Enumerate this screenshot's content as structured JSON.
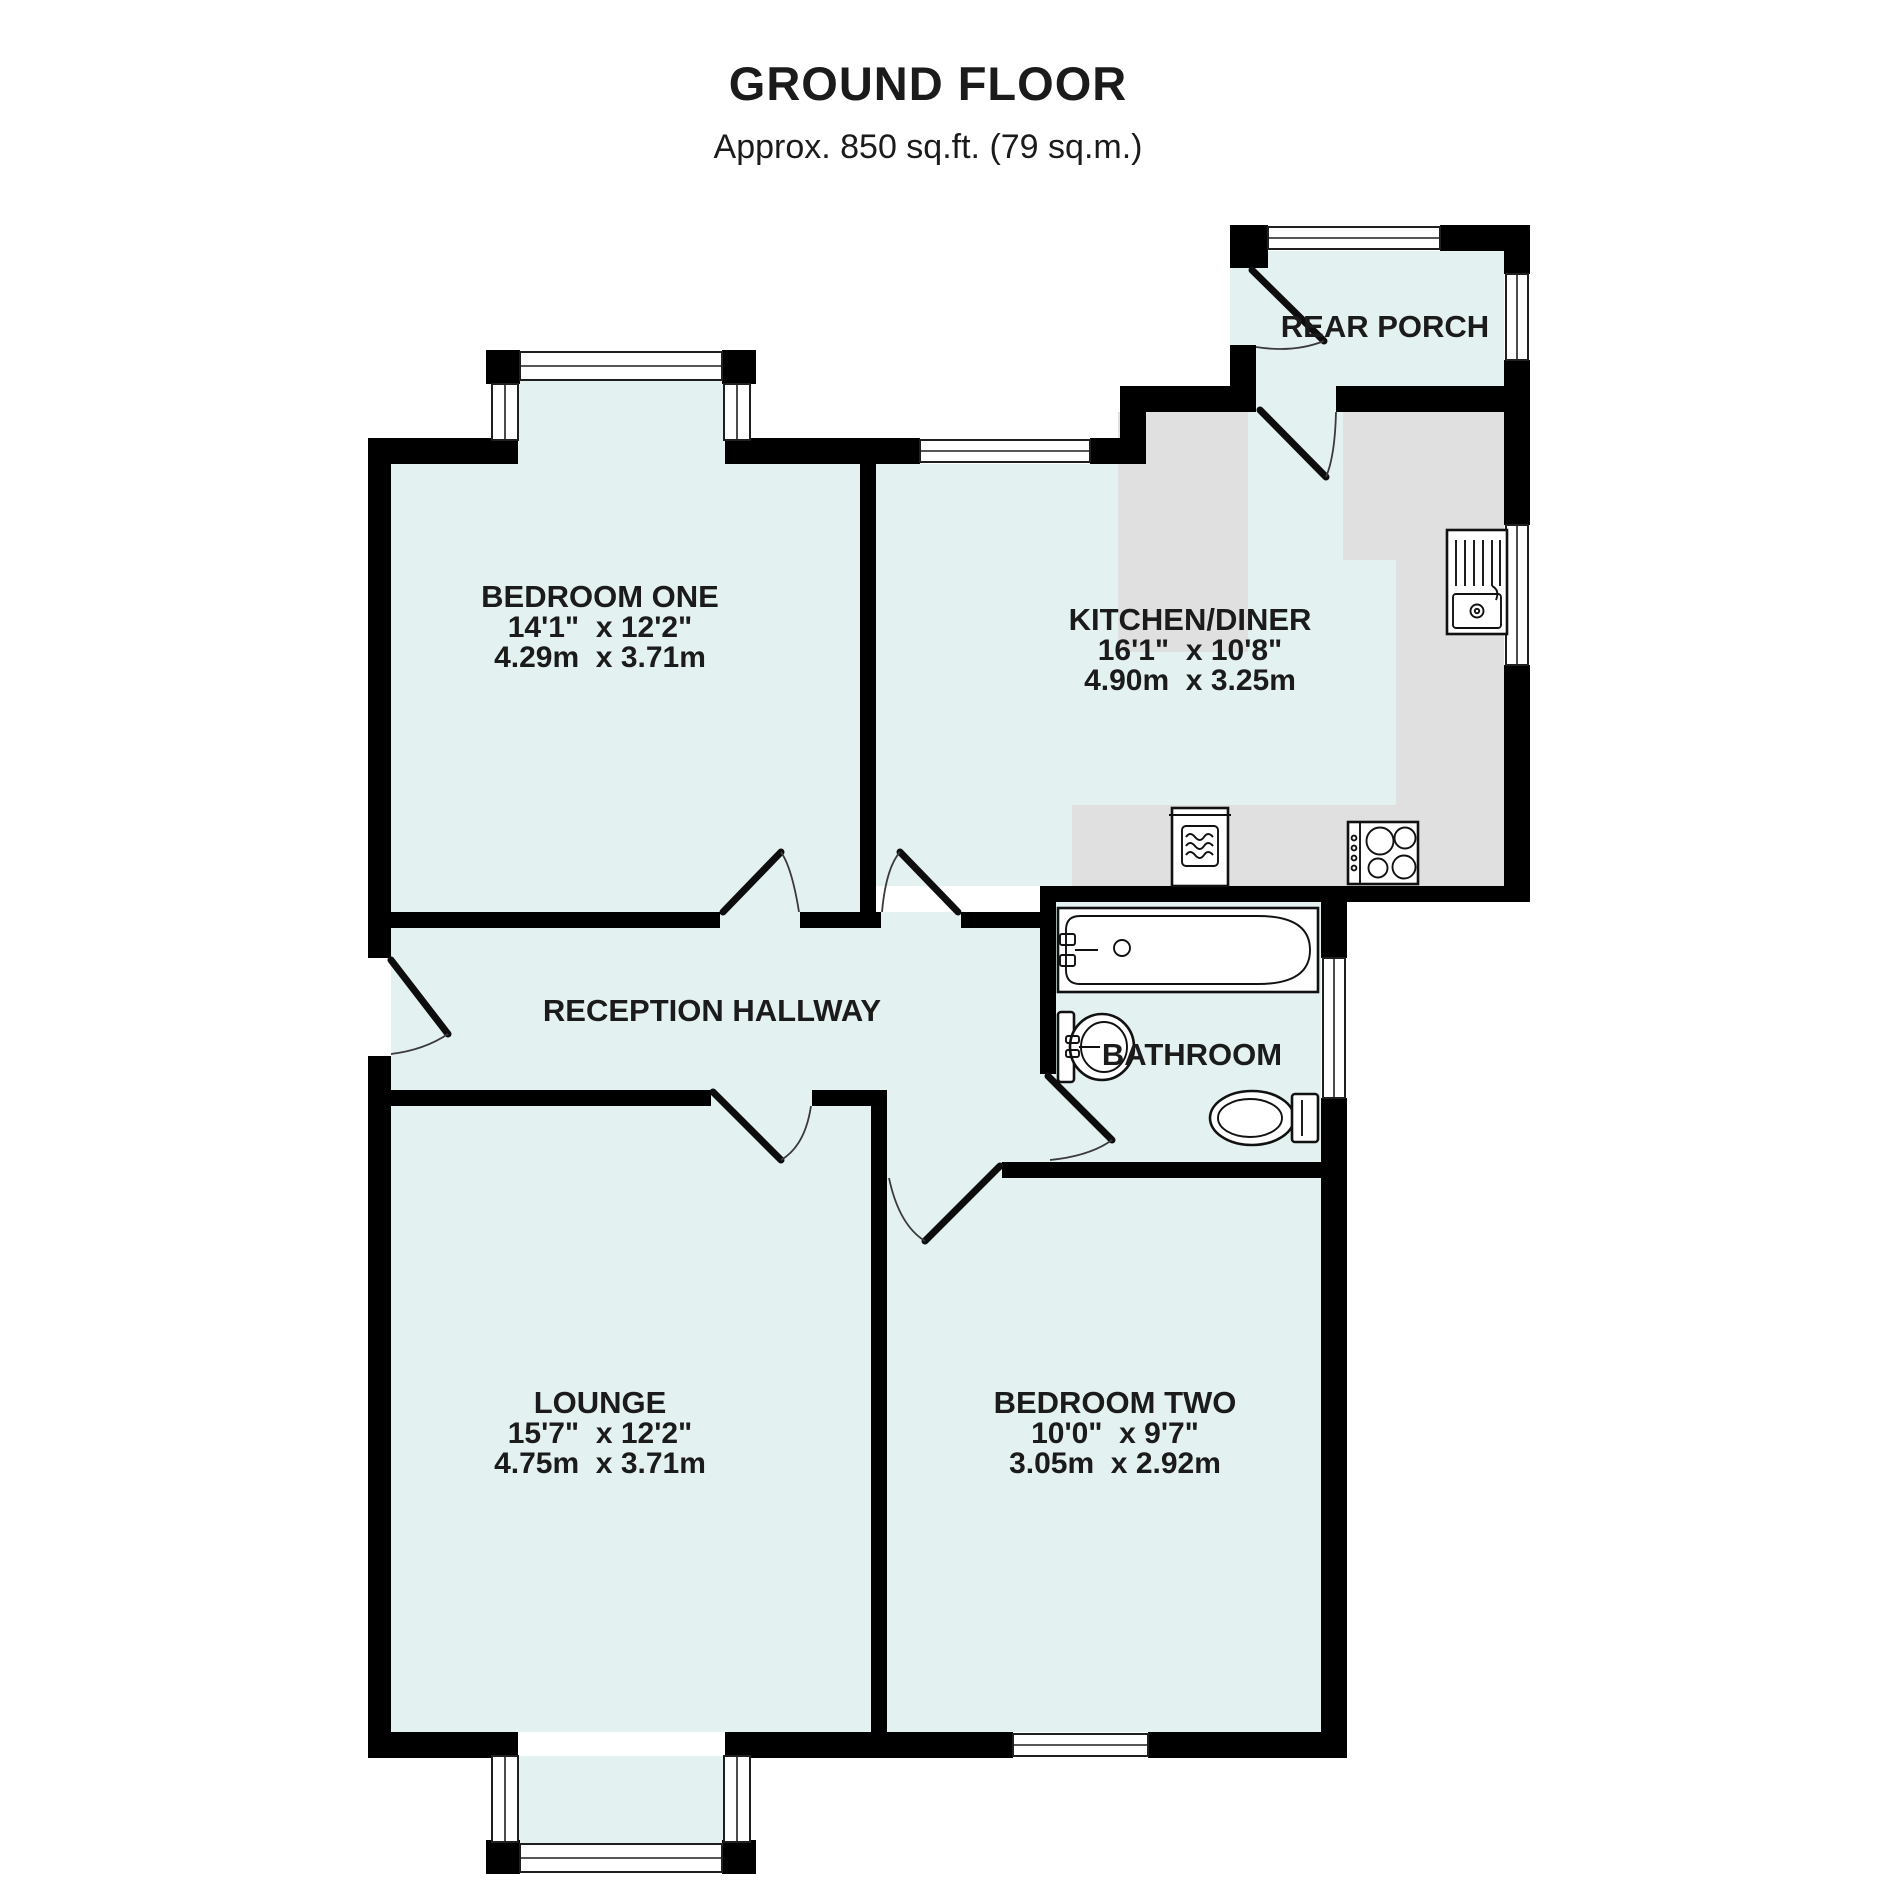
{
  "header": {
    "title": "GROUND FLOOR",
    "subtitle": "Approx. 850 sq.ft. (79 sq.m.)"
  },
  "rooms": [
    {
      "id": "bedroom-one",
      "name": "BEDROOM ONE",
      "imperial": "14'1\"  x 12'2\"",
      "metric": "4.29m  x 3.71m"
    },
    {
      "id": "kitchen-diner",
      "name": "KITCHEN/DINER",
      "imperial": "16'1\"  x 10'8\"",
      "metric": "4.90m  x 3.25m"
    },
    {
      "id": "rear-porch",
      "name": "REAR PORCH"
    },
    {
      "id": "reception-hallway",
      "name": "RECEPTION HALLWAY"
    },
    {
      "id": "bathroom",
      "name": "BATHROOM"
    },
    {
      "id": "lounge",
      "name": "LOUNGE",
      "imperial": "15'7\"  x 12'2\"",
      "metric": "4.75m  x 3.71m"
    },
    {
      "id": "bedroom-two",
      "name": "BEDROOM TWO",
      "imperial": "10'0\"  x 9'7\"",
      "metric": "3.05m  x 2.92m"
    }
  ],
  "fixtures": [
    "bath",
    "wash-basin",
    "toilet",
    "kitchen-sink-drainer",
    "washing-machine",
    "hob",
    "bay-window",
    "window",
    "door-swing"
  ],
  "colors": {
    "floor": "#e4f1f1",
    "wall": "#000000",
    "worktop": "#e0e0e0",
    "text": "#1b1b1b",
    "background": "#ffffff"
  }
}
